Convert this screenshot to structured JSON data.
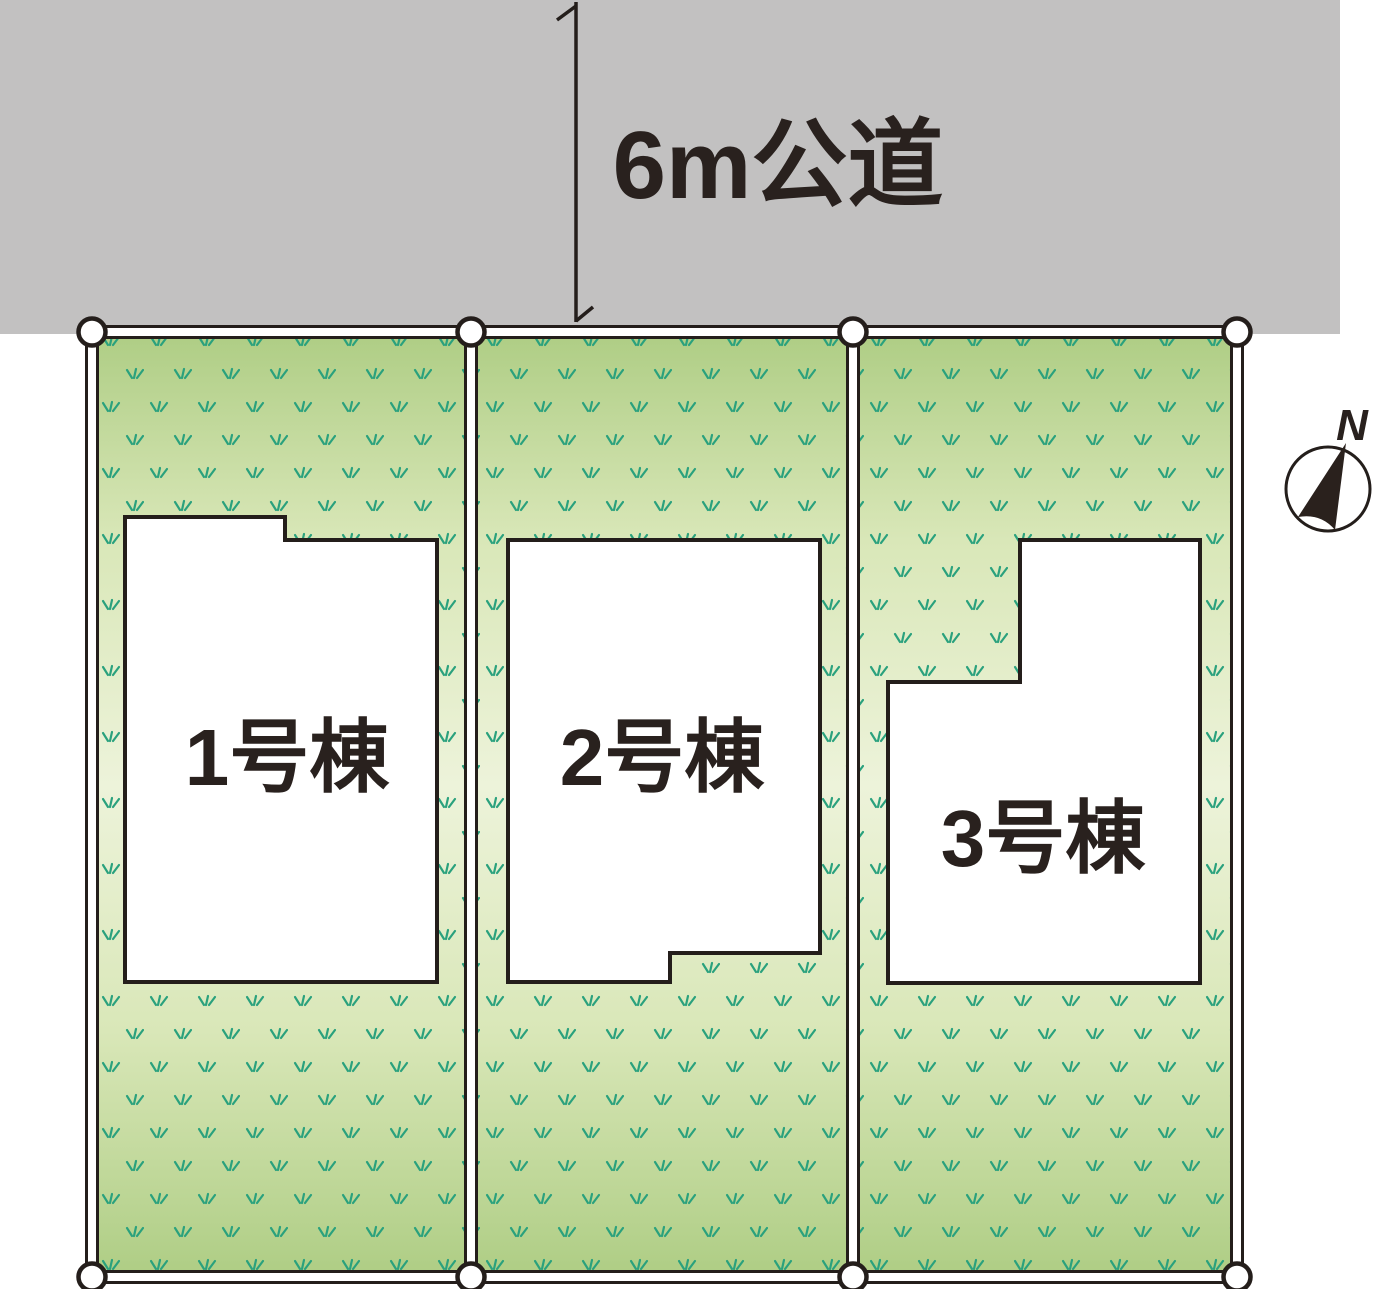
{
  "road": {
    "label": "6m公道"
  },
  "lots": [
    {
      "label": "1号棟"
    },
    {
      "label": "2号棟"
    },
    {
      "label": "3号棟"
    }
  ],
  "compass": {
    "label": "N"
  },
  "colors": {
    "road": "#c2c1c1",
    "ink": "#241e1b",
    "label_text": "#29211e",
    "grass_dark": "#aecd84",
    "grass_mid": "#d9e7b8",
    "grass_light": "#edf3da",
    "grass_blade": "#2aa17d",
    "building_fill": "#ffffff",
    "marker_fill": "#ffffff",
    "needle_fill": "#2a211d"
  }
}
